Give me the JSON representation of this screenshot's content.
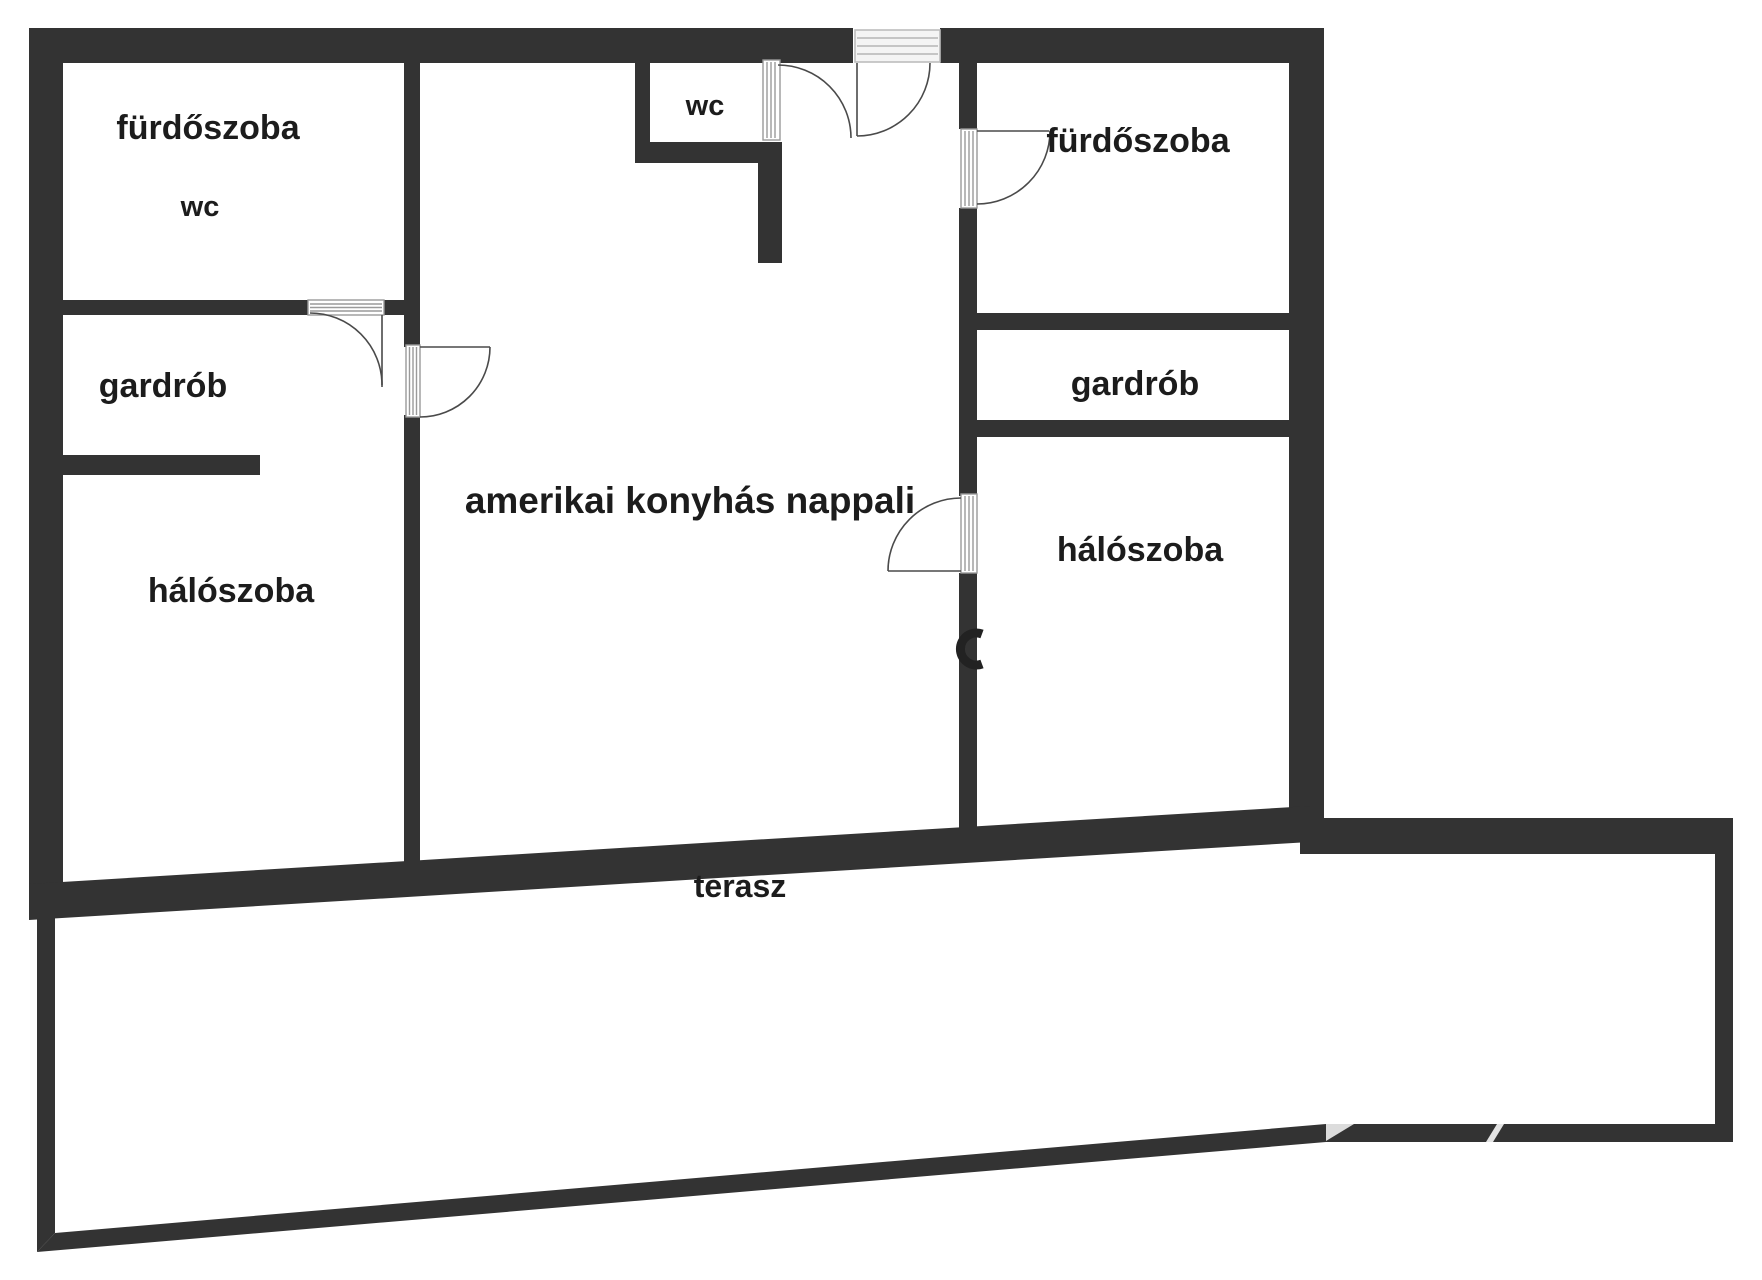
{
  "floorplan": {
    "title": "apartment floor plan",
    "rooms": [
      {
        "id": "bathroom-left",
        "label": "fürdőszoba"
      },
      {
        "id": "wc-left",
        "label": "wc"
      },
      {
        "id": "wc-small",
        "label": "wc"
      },
      {
        "id": "bathroom-right",
        "label": "fürdőszoba"
      },
      {
        "id": "wardrobe-left",
        "label": "gardrób"
      },
      {
        "id": "wardrobe-right",
        "label": "gardrób"
      },
      {
        "id": "bedroom-left",
        "label": "hálószoba"
      },
      {
        "id": "bedroom-right",
        "label": "hálószoba"
      },
      {
        "id": "living",
        "label": "amerikai konyhás nappali"
      },
      {
        "id": "terrace",
        "label": "terasz"
      }
    ],
    "colors": {
      "wall": "#333333",
      "background": "#ffffff",
      "door_line": "#4a4a4a",
      "hatch_line": "#9a9a9a",
      "threshold_fill": "#f4f4f4",
      "label_text": "#1c1c1c",
      "artifact_light": "#dcdcdc"
    }
  }
}
